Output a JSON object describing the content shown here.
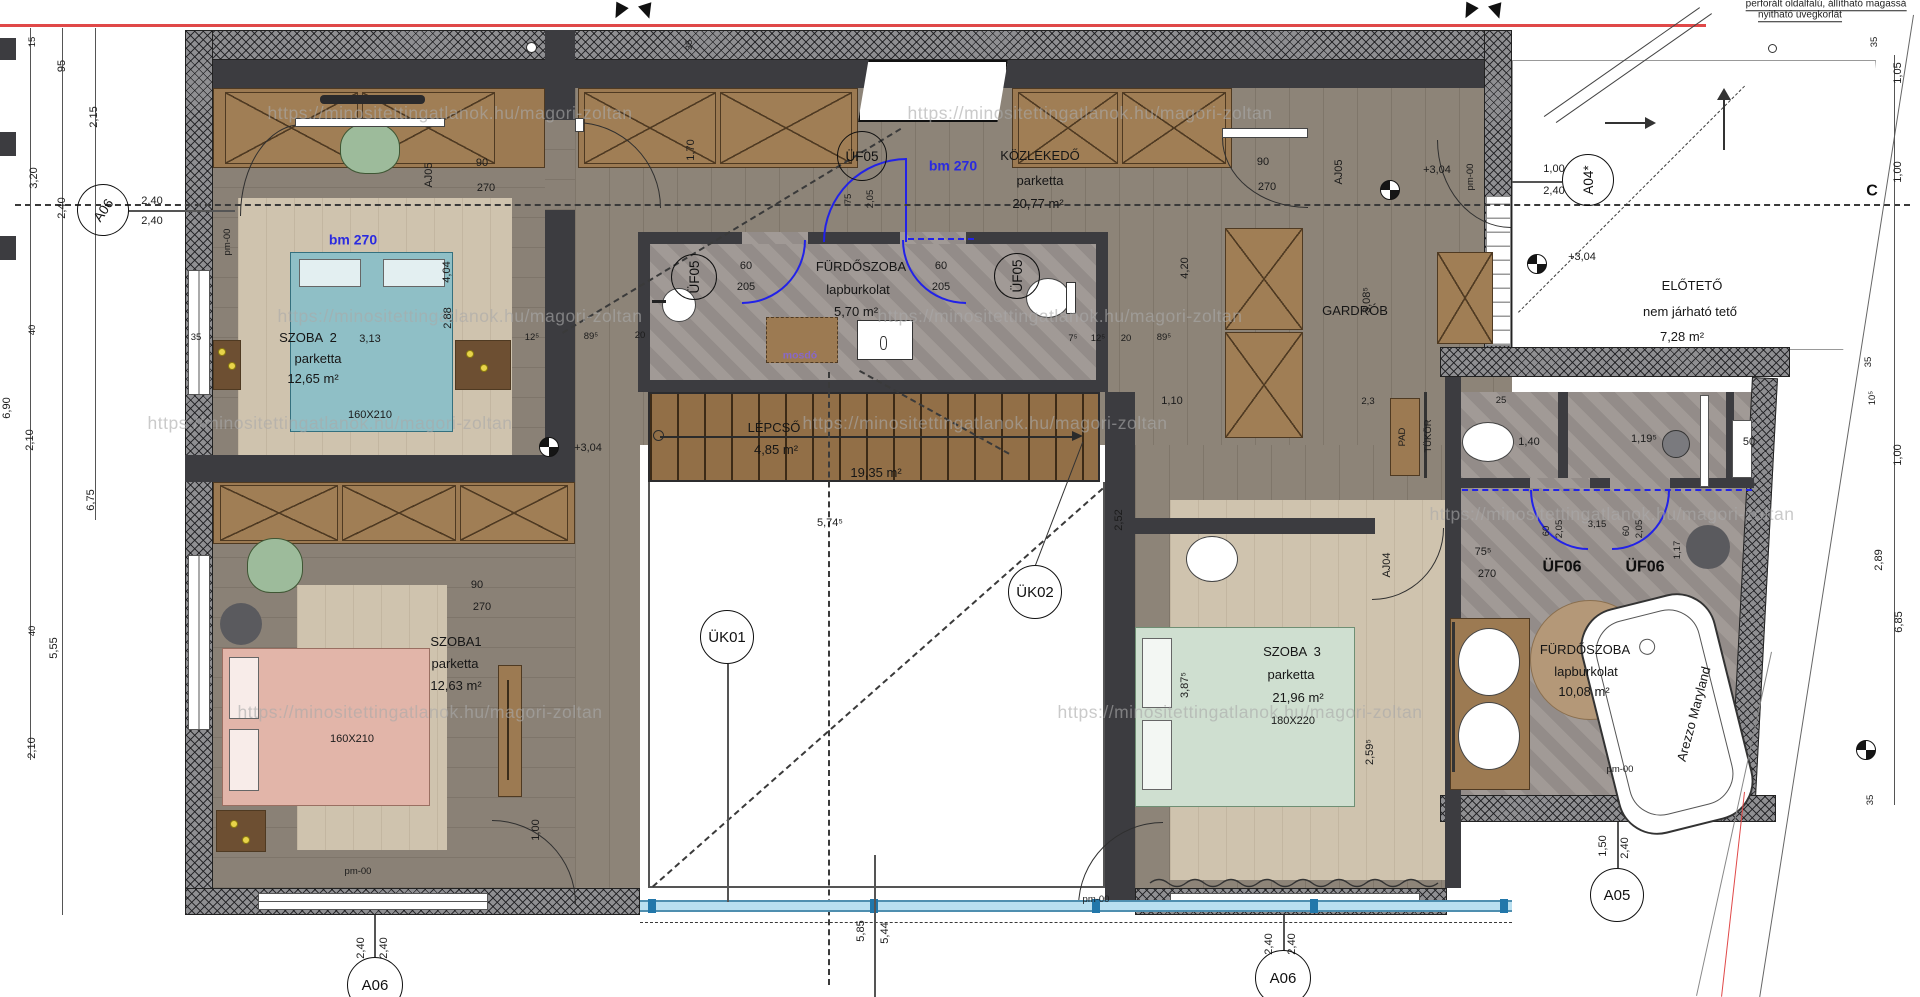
{
  "watermark": "https://minositettingatlanok.hu/magori-zoltan",
  "colors": {
    "wall": "#3c3c40",
    "wood_floor": "#8d8478",
    "rug": "#cfc3ae",
    "cabinet": "#9c7a52",
    "tile": "#9b9490",
    "bed_teal": "#8fbfc6",
    "bed_pink": "#e2b5a9",
    "bed_green": "#cfdfd0",
    "accent_blue": "#2222e8",
    "boundary_red": "#e04848",
    "glass": "#b9dff0"
  },
  "rooms": [
    {
      "name": "SZOBA  2",
      "floor": "parketta",
      "area": "12,65 m²",
      "extra": "3,13",
      "bed": "160X210"
    },
    {
      "name": "SZOBA1",
      "floor": "parketta",
      "area": "12,63 m²",
      "bed": "160X210"
    },
    {
      "name": "FÜRDŐSZOBA",
      "floor": "lapburkolat",
      "area": "5,70 m²"
    },
    {
      "name": "KÖZLEKEDŐ",
      "floor": "parketta",
      "area": "20,77 m²"
    },
    {
      "name": "LÉPCSŐ",
      "area": "4,85 m²",
      "void_area": "19,35 m²"
    },
    {
      "name": "GARDRÓB"
    },
    {
      "name": "SZOBA  3",
      "floor": "parketta",
      "area": "21,96 m²",
      "bed": "180X220"
    },
    {
      "name": "FÜRDŐSZOBA",
      "floor": "lapburkolat",
      "area": "10,08 m²",
      "tub": "Arezzo Maryland"
    },
    {
      "name": "ELŐTETŐ",
      "floor": "nem járható tető",
      "area": "7,28 m²"
    }
  ],
  "markers": [
    {
      "n": "marker-uf05-top",
      "t": "ÜF05",
      "x": 862,
      "y": 156,
      "d": 50
    },
    {
      "n": "marker-uf05-left",
      "t": "ÜF05",
      "x": 694,
      "y": 277,
      "d": 46,
      "r": -90
    },
    {
      "n": "marker-uf05-right",
      "t": "ÜF05",
      "x": 1017,
      "y": 276,
      "d": 46,
      "r": -90
    },
    {
      "n": "marker-uk01",
      "t": "ÜK01",
      "x": 727,
      "y": 637,
      "d": 54
    },
    {
      "n": "marker-uk02",
      "t": "ÜK02",
      "x": 1035,
      "y": 592,
      "d": 54
    },
    {
      "n": "marker-a06-left",
      "t": "A06",
      "x": 103,
      "y": 210,
      "d": 52,
      "r": -55
    },
    {
      "n": "marker-a06-bottom-left",
      "t": "A06",
      "x": 375,
      "y": 985,
      "d": 56
    },
    {
      "n": "marker-a06-bottom-right",
      "t": "A06",
      "x": 1283,
      "y": 978,
      "d": 56
    },
    {
      "n": "marker-a05",
      "t": "A05",
      "x": 1617,
      "y": 895,
      "d": 54
    },
    {
      "n": "marker-a04star",
      "t": "A04*",
      "x": 1588,
      "y": 180,
      "d": 52,
      "r": -90
    }
  ],
  "level_markers": [
    {
      "n": "level-marker-stairs",
      "x": 549,
      "y": 447
    },
    {
      "n": "level-marker-corridor",
      "x": 1390,
      "y": 190
    },
    {
      "n": "level-marker-canopy",
      "x": 1537,
      "y": 264
    },
    {
      "n": "level-marker-right",
      "x": 1866,
      "y": 750
    }
  ],
  "labels": [
    {
      "n": "watermark",
      "t": "https://minositettingatlanok.hu/magori-zoltan",
      "x": 450,
      "y": 113,
      "c": "wm"
    },
    {
      "n": "watermark",
      "t": "https://minositettingatlanok.hu/magori-zoltan",
      "x": 1090,
      "y": 113,
      "c": "wm"
    },
    {
      "n": "watermark",
      "t": "https://minositettingatlanok.hu/magori-zoltan",
      "x": 460,
      "y": 316,
      "c": "wm"
    },
    {
      "n": "watermark",
      "t": "https://minositettingatlanok.hu/magori-zoltan",
      "x": 1060,
      "y": 316,
      "c": "wm"
    },
    {
      "n": "watermark",
      "t": "https://minositettingatlanok.hu/magori-zoltan",
      "x": 330,
      "y": 423,
      "c": "wm"
    },
    {
      "n": "watermark",
      "t": "https://minositettingatlanok.hu/magori-zoltan",
      "x": 985,
      "y": 423,
      "c": "wm"
    },
    {
      "n": "watermark",
      "t": "https://minositettingatlanok.hu/magori-zoltan",
      "x": 420,
      "y": 712,
      "c": "wm"
    },
    {
      "n": "watermark",
      "t": "https://minositettingatlanok.hu/magori-zoltan",
      "x": 1240,
      "y": 712,
      "c": "wm"
    },
    {
      "n": "watermark",
      "t": "https://minositettingatlanok.hu/magori-zoltan",
      "x": 1612,
      "y": 514,
      "c": "wm"
    },
    {
      "n": "dim",
      "t": "1,70",
      "x": 692,
      "y": 150,
      "r": -90
    },
    {
      "n": "dim",
      "t": "75",
      "x": 849,
      "y": 199,
      "r": -90,
      "c": "ds"
    },
    {
      "n": "dim",
      "t": "2,05",
      "x": 871,
      "y": 199,
      "r": -90,
      "c": "ds"
    },
    {
      "n": "door-height-label",
      "t": "bm 270",
      "x": 953,
      "y": 166,
      "c": "bl"
    },
    {
      "n": "door-height-label",
      "t": "bm 270",
      "x": 353,
      "y": 240,
      "c": "bl"
    },
    {
      "n": "room-name",
      "t": "KÖZLEKEDŐ",
      "x": 1040,
      "y": 156,
      "c": "rm"
    },
    {
      "n": "room-floor",
      "t": "parketta",
      "x": 1040,
      "y": 181,
      "c": "rm"
    },
    {
      "n": "room-area",
      "t": "20,77 m²",
      "x": 1038,
      "y": 204,
      "c": "rm"
    },
    {
      "n": "dim",
      "t": "pm-00",
      "x": 228,
      "y": 242,
      "r": -90,
      "c": "ds"
    },
    {
      "n": "door-dim",
      "t": "90",
      "x": 482,
      "y": 164
    },
    {
      "n": "door-dim",
      "t": "270",
      "x": 486,
      "y": 189
    },
    {
      "n": "door-code",
      "t": "AJ05",
      "x": 430,
      "y": 175,
      "r": -90
    },
    {
      "n": "door-dim",
      "t": "90",
      "x": 1263,
      "y": 163
    },
    {
      "n": "door-dim",
      "t": "270",
      "x": 1267,
      "y": 188
    },
    {
      "n": "door-code",
      "t": "AJ05",
      "x": 1340,
      "y": 172,
      "r": -90
    },
    {
      "n": "level-text",
      "t": "+3,04",
      "x": 1437,
      "y": 171
    },
    {
      "n": "dim",
      "t": "pm-00",
      "x": 1471,
      "y": 177,
      "r": -90,
      "c": "ds"
    },
    {
      "n": "dim",
      "t": "1,00",
      "x": 1554,
      "y": 170
    },
    {
      "n": "dim",
      "t": "2,40",
      "x": 1554,
      "y": 192
    },
    {
      "n": "dim",
      "t": "3,08⁵",
      "x": 1368,
      "y": 300,
      "r": -90
    },
    {
      "n": "dim",
      "t": "4,20",
      "x": 1186,
      "y": 268,
      "r": -90
    },
    {
      "n": "room-name",
      "t": "GARDRÓB",
      "x": 1355,
      "y": 311,
      "c": "rm"
    },
    {
      "n": "dim",
      "t": "35",
      "x": 690,
      "y": 45,
      "r": -90,
      "c": "ds"
    },
    {
      "n": "room-name",
      "t": "SZOBA  2",
      "x": 308,
      "y": 338,
      "c": "rm"
    },
    {
      "n": "dim",
      "t": "3,13",
      "x": 370,
      "y": 340
    },
    {
      "n": "room-floor",
      "t": "parketta",
      "x": 318,
      "y": 359,
      "c": "rm"
    },
    {
      "n": "room-area",
      "t": "12,65 m²",
      "x": 313,
      "y": 379,
      "c": "rm"
    },
    {
      "n": "bed-size",
      "t": "160X210",
      "x": 370,
      "y": 416
    },
    {
      "n": "dim",
      "t": "4,04",
      "x": 448,
      "y": 272,
      "r": -90
    },
    {
      "n": "dim",
      "t": "2,88",
      "x": 449,
      "y": 318,
      "r": -90
    },
    {
      "n": "dim",
      "t": "35",
      "x": 196,
      "y": 338,
      "c": "ds"
    },
    {
      "n": "dim",
      "t": "12⁵",
      "x": 532,
      "y": 338,
      "c": "ds"
    },
    {
      "n": "dim",
      "t": "89⁵",
      "x": 591,
      "y": 337,
      "c": "ds"
    },
    {
      "n": "room-name",
      "t": "FÜRDŐSZOBA",
      "x": 861,
      "y": 267,
      "c": "rm"
    },
    {
      "n": "room-floor",
      "t": "lapburkolat",
      "x": 858,
      "y": 290,
      "c": "rm"
    },
    {
      "n": "room-area",
      "t": "5,70 m²",
      "x": 856,
      "y": 312,
      "c": "rm"
    },
    {
      "n": "door-dim",
      "t": "60",
      "x": 746,
      "y": 267
    },
    {
      "n": "door-dim",
      "t": "205",
      "x": 746,
      "y": 288
    },
    {
      "n": "door-dim",
      "t": "60",
      "x": 941,
      "y": 267
    },
    {
      "n": "door-dim",
      "t": "205",
      "x": 941,
      "y": 288
    },
    {
      "n": "fixture-label",
      "t": "mosdó",
      "x": 800,
      "y": 356,
      "c": "vi"
    },
    {
      "n": "dim",
      "t": "20",
      "x": 640,
      "y": 336,
      "c": "ds"
    },
    {
      "n": "dim",
      "t": "7⁵",
      "x": 1073,
      "y": 339,
      "c": "ds"
    },
    {
      "n": "dim",
      "t": "12⁵",
      "x": 1098,
      "y": 339,
      "c": "ds"
    },
    {
      "n": "dim",
      "t": "20",
      "x": 1126,
      "y": 339,
      "c": "ds"
    },
    {
      "n": "dim",
      "t": "89⁵",
      "x": 1164,
      "y": 338,
      "c": "ds"
    },
    {
      "n": "dim",
      "t": "1,10",
      "x": 1172,
      "y": 402
    },
    {
      "n": "dim",
      "t": "2,3",
      "x": 1368,
      "y": 402,
      "c": "ds"
    },
    {
      "n": "fixture-label",
      "t": "PAD",
      "x": 1403,
      "y": 437,
      "r": -90,
      "c": "ds"
    },
    {
      "n": "fixture-label",
      "t": "TÜKÖR",
      "x": 1429,
      "y": 436,
      "r": -90,
      "c": "ds"
    },
    {
      "n": "room-name",
      "t": "LÉPCSŐ",
      "x": 774,
      "y": 428,
      "c": "rm"
    },
    {
      "n": "room-area",
      "t": "4,85 m²",
      "x": 776,
      "y": 450,
      "c": "rm"
    },
    {
      "n": "room-area",
      "t": "19,35 m²",
      "x": 876,
      "y": 473,
      "c": "rm"
    },
    {
      "n": "level-text",
      "t": "+3,04",
      "x": 588,
      "y": 449
    },
    {
      "n": "dim",
      "t": "5,74⁵",
      "x": 830,
      "y": 524
    },
    {
      "n": "dim",
      "t": "1,00",
      "x": 537,
      "y": 830,
      "r": -90
    },
    {
      "n": "dim",
      "t": "2,52",
      "x": 1120,
      "y": 520,
      "r": -90
    },
    {
      "n": "dim",
      "t": "5,85",
      "x": 862,
      "y": 931,
      "r": -90
    },
    {
      "n": "dim",
      "t": "5,44",
      "x": 886,
      "y": 933,
      "r": -90
    },
    {
      "n": "door-dim",
      "t": "90",
      "x": 477,
      "y": 586
    },
    {
      "n": "door-dim",
      "t": "270",
      "x": 482,
      "y": 608
    },
    {
      "n": "room-name",
      "t": "SZOBA1",
      "x": 456,
      "y": 642,
      "c": "rm"
    },
    {
      "n": "room-floor",
      "t": "parketta",
      "x": 455,
      "y": 664,
      "c": "rm"
    },
    {
      "n": "room-area",
      "t": "12,63 m²",
      "x": 456,
      "y": 686,
      "c": "rm"
    },
    {
      "n": "bed-size",
      "t": "160X210",
      "x": 352,
      "y": 740
    },
    {
      "n": "dim",
      "t": "pm-00",
      "x": 358,
      "y": 872,
      "c": "ds"
    },
    {
      "n": "room-name",
      "t": "SZOBA  3",
      "x": 1292,
      "y": 652,
      "c": "rm"
    },
    {
      "n": "room-floor",
      "t": "parketta",
      "x": 1291,
      "y": 675,
      "c": "rm"
    },
    {
      "n": "room-area",
      "t": "21,96 m²",
      "x": 1298,
      "y": 698,
      "c": "rm"
    },
    {
      "n": "bed-size",
      "t": "180X220",
      "x": 1293,
      "y": 722
    },
    {
      "n": "dim",
      "t": "3,87⁵",
      "x": 1186,
      "y": 685,
      "r": -90
    },
    {
      "n": "dim",
      "t": "2,59⁵",
      "x": 1371,
      "y": 752,
      "r": -90
    },
    {
      "n": "door-code",
      "t": "AJ04",
      "x": 1388,
      "y": 565,
      "r": -90
    },
    {
      "n": "door-dim",
      "t": "75⁵",
      "x": 1483,
      "y": 553
    },
    {
      "n": "door-dim",
      "t": "270",
      "x": 1487,
      "y": 575
    },
    {
      "n": "dim",
      "t": "pm-00",
      "x": 1096,
      "y": 900,
      "c": "ds"
    },
    {
      "n": "dim",
      "t": "25",
      "x": 1501,
      "y": 401,
      "c": "ds"
    },
    {
      "n": "dim",
      "t": "1,40",
      "x": 1529,
      "y": 443
    },
    {
      "n": "dim",
      "t": "1,19⁵",
      "x": 1644,
      "y": 440
    },
    {
      "n": "dim",
      "t": "50",
      "x": 1749,
      "y": 443
    },
    {
      "n": "door-code",
      "t": "ÜF06",
      "x": 1562,
      "y": 568,
      "c": "bg"
    },
    {
      "n": "door-code",
      "t": "ÜF06",
      "x": 1645,
      "y": 568,
      "c": "bg"
    },
    {
      "n": "door-dim",
      "t": "60",
      "x": 1547,
      "y": 531,
      "r": -90,
      "c": "ds"
    },
    {
      "n": "door-dim",
      "t": "2,05",
      "x": 1560,
      "y": 529,
      "r": -90,
      "c": "ds"
    },
    {
      "n": "door-dim",
      "t": "60",
      "x": 1627,
      "y": 531,
      "r": -90,
      "c": "ds"
    },
    {
      "n": "door-dim",
      "t": "2,05",
      "x": 1640,
      "y": 529,
      "r": -90,
      "c": "ds"
    },
    {
      "n": "dim",
      "t": "1,17",
      "x": 1678,
      "y": 550,
      "r": -90,
      "c": "ds"
    },
    {
      "n": "dim",
      "t": "3,15",
      "x": 1597,
      "y": 525,
      "c": "ds"
    },
    {
      "n": "room-name",
      "t": "FÜRDŐSZOBA",
      "x": 1585,
      "y": 650,
      "c": "rm"
    },
    {
      "n": "room-floor",
      "t": "lapburkolat",
      "x": 1586,
      "y": 672,
      "c": "rm"
    },
    {
      "n": "room-area",
      "t": "10,08 m²",
      "x": 1584,
      "y": 692,
      "c": "rm"
    },
    {
      "n": "fixture-label",
      "t": "Arezzo Maryland",
      "x": 1694,
      "y": 714,
      "r": -75,
      "c": "rm"
    },
    {
      "n": "dim",
      "t": "pm-00",
      "x": 1620,
      "y": 770,
      "c": "ds"
    },
    {
      "n": "dim",
      "t": "1,50",
      "x": 1604,
      "y": 846,
      "r": -90
    },
    {
      "n": "dim",
      "t": "2,40",
      "x": 1626,
      "y": 848,
      "r": -90
    },
    {
      "n": "room-name",
      "t": "ELŐTETŐ",
      "x": 1692,
      "y": 286,
      "c": "rm"
    },
    {
      "n": "room-floor",
      "t": "nem járható tető",
      "x": 1690,
      "y": 312,
      "c": "rm"
    },
    {
      "n": "room-area",
      "t": "7,28 m²",
      "x": 1682,
      "y": 337,
      "c": "rm"
    },
    {
      "n": "level-text",
      "t": "+3,04",
      "x": 1582,
      "y": 258
    },
    {
      "n": "dim",
      "t": "15",
      "x": 33,
      "y": 42,
      "r": -90,
      "c": "ds"
    },
    {
      "n": "dim",
      "t": "95",
      "x": 63,
      "y": 66,
      "r": -90
    },
    {
      "n": "dim",
      "t": "2,15",
      "x": 95,
      "y": 117,
      "r": -90
    },
    {
      "n": "dim",
      "t": "3,20",
      "x": 35,
      "y": 178,
      "r": -90
    },
    {
      "n": "dim",
      "t": "2,40",
      "x": 63,
      "y": 208,
      "r": -90
    },
    {
      "n": "dim",
      "t": "2,40",
      "x": 152,
      "y": 202
    },
    {
      "n": "dim",
      "t": "2,40",
      "x": 152,
      "y": 222
    },
    {
      "n": "dim",
      "t": "40",
      "x": 33,
      "y": 330,
      "r": -90,
      "c": "ds"
    },
    {
      "n": "dim",
      "t": "6,90",
      "x": 8,
      "y": 408,
      "r": -90
    },
    {
      "n": "dim",
      "t": "2,10",
      "x": 31,
      "y": 440,
      "r": -90
    },
    {
      "n": "dim",
      "t": "6,75",
      "x": 92,
      "y": 500,
      "r": -90
    },
    {
      "n": "dim",
      "t": "40",
      "x": 33,
      "y": 631,
      "r": -90,
      "c": "ds"
    },
    {
      "n": "dim",
      "t": "5,55",
      "x": 55,
      "y": 648,
      "r": -90
    },
    {
      "n": "dim",
      "t": "2,10",
      "x": 33,
      "y": 748,
      "r": -90
    },
    {
      "n": "dim",
      "t": "35",
      "x": 1875,
      "y": 42,
      "r": -90,
      "c": "ds"
    },
    {
      "n": "dim",
      "t": "1,05",
      "x": 1899,
      "y": 73,
      "r": -90
    },
    {
      "n": "dim",
      "t": "1,00",
      "x": 1899,
      "y": 172,
      "r": -90
    },
    {
      "n": "section-letter",
      "t": "C",
      "x": 1872,
      "y": 192,
      "c": "bg"
    },
    {
      "n": "dim",
      "t": "35",
      "x": 1869,
      "y": 362,
      "r": -90,
      "c": "ds"
    },
    {
      "n": "dim",
      "t": "10⁵",
      "x": 1873,
      "y": 398,
      "r": -90,
      "c": "ds"
    },
    {
      "n": "dim",
      "t": "1,00",
      "x": 1899,
      "y": 455,
      "r": -90
    },
    {
      "n": "dim",
      "t": "2,89",
      "x": 1880,
      "y": 560,
      "r": -90
    },
    {
      "n": "dim",
      "t": "6,85",
      "x": 1900,
      "y": 622,
      "r": -90
    },
    {
      "n": "dim",
      "t": "35",
      "x": 1871,
      "y": 800,
      "r": -90,
      "c": "ds"
    },
    {
      "n": "dim",
      "t": "2,40",
      "x": 362,
      "y": 948,
      "r": -90
    },
    {
      "n": "dim",
      "t": "2,40",
      "x": 385,
      "y": 948,
      "r": -90
    },
    {
      "n": "dim",
      "t": "2,40",
      "x": 1270,
      "y": 944,
      "r": -90
    },
    {
      "n": "dim",
      "t": "2,40",
      "x": 1293,
      "y": 944,
      "r": -90
    },
    {
      "n": "note",
      "t": "perforált oldalfalú, állítható magassá",
      "x": 1826,
      "y": 5,
      "c": "nt"
    },
    {
      "n": "note",
      "t": "nyitható üvegkorlát",
      "x": 1800,
      "y": 16,
      "c": "nt"
    }
  ]
}
